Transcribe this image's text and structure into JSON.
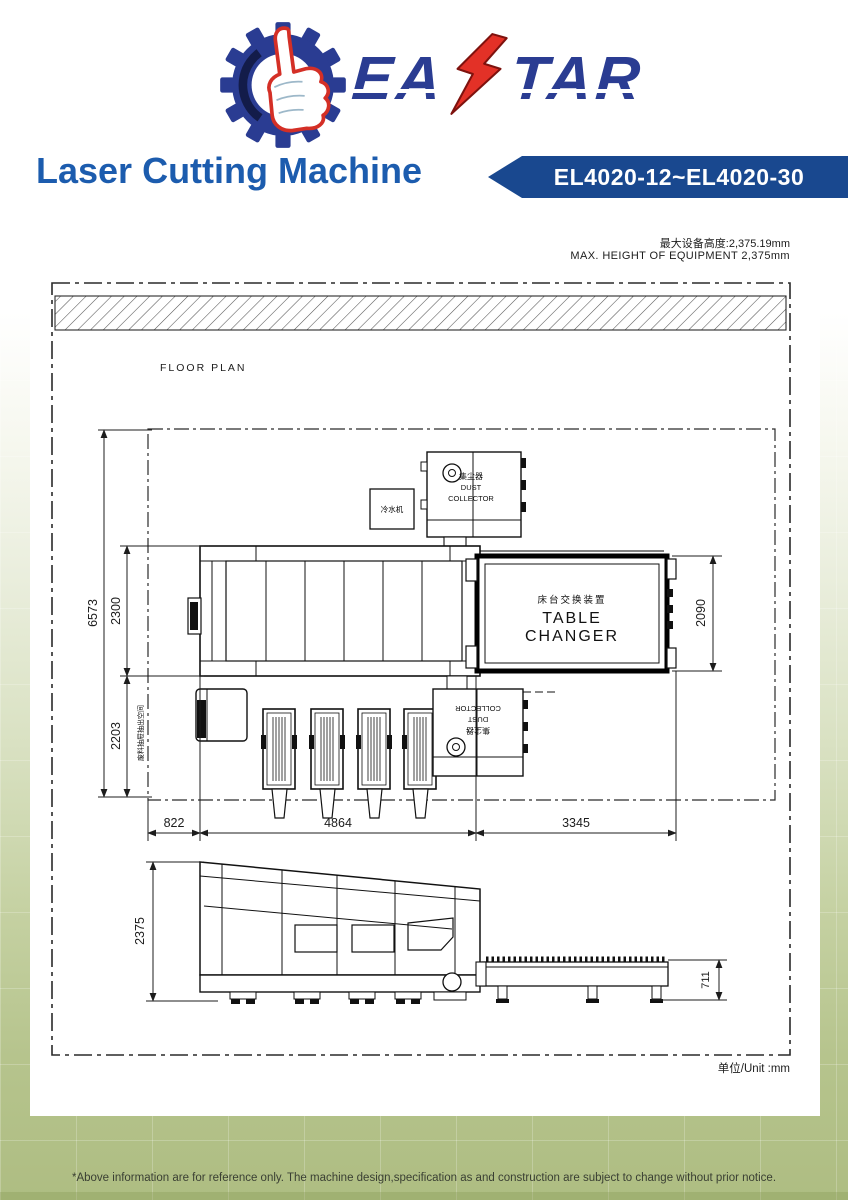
{
  "brand": {
    "wordmark_left": "EA",
    "wordmark_right": "TAR"
  },
  "header": {
    "title": "Laser Cutting Machine",
    "model_badge": "EL4020-12~EL4020-30"
  },
  "drawing": {
    "notes": {
      "max_height_cn": "最大设备高度:2,375.19mm",
      "max_height_en": "MAX. HEIGHT OF EQUIPMENT 2,375mm"
    },
    "labels": {
      "floor_plan": "FLOOR PLAN",
      "unit": "单位/Unit :mm",
      "table_changer_cn": "床台交换装置",
      "table_changer_en": "TABLE CHANGER",
      "dust_cn": "集尘器",
      "dust_en1": "DUST",
      "dust_en2": "COLLECTOR",
      "chiller": "冷水机",
      "drawer_note": "废料抽屉抽出空间"
    },
    "dims": {
      "depth_total": "6573",
      "depth_machine": "2300",
      "depth_drawer": "2203",
      "changer_depth": "2090",
      "front_offset": "822",
      "machine_length": "4864",
      "changer_length": "3345",
      "machine_height": "2375",
      "table_height": "711"
    }
  },
  "footer": {
    "disclaimer": "*Above information are for reference only. The machine design,specification as and construction are subject to change without prior notice."
  }
}
